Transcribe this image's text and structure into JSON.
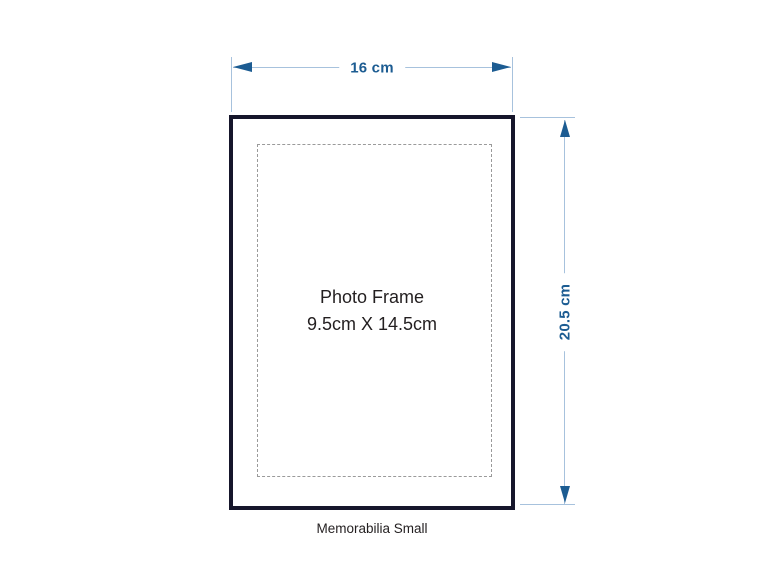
{
  "diagram": {
    "frame_label_line1": "Photo Frame",
    "frame_label_line2": "9.5cm X 14.5cm",
    "width_dimension": "16 cm",
    "height_dimension": "20.5 cm",
    "caption": "Memorabilia Small",
    "colors": {
      "dimension_accent": "#1c5c92",
      "dimension_line": "#a7c2dd",
      "frame_border": "#16162b",
      "matte_dashed": "#9a9a9a",
      "text": "#231f20"
    }
  }
}
